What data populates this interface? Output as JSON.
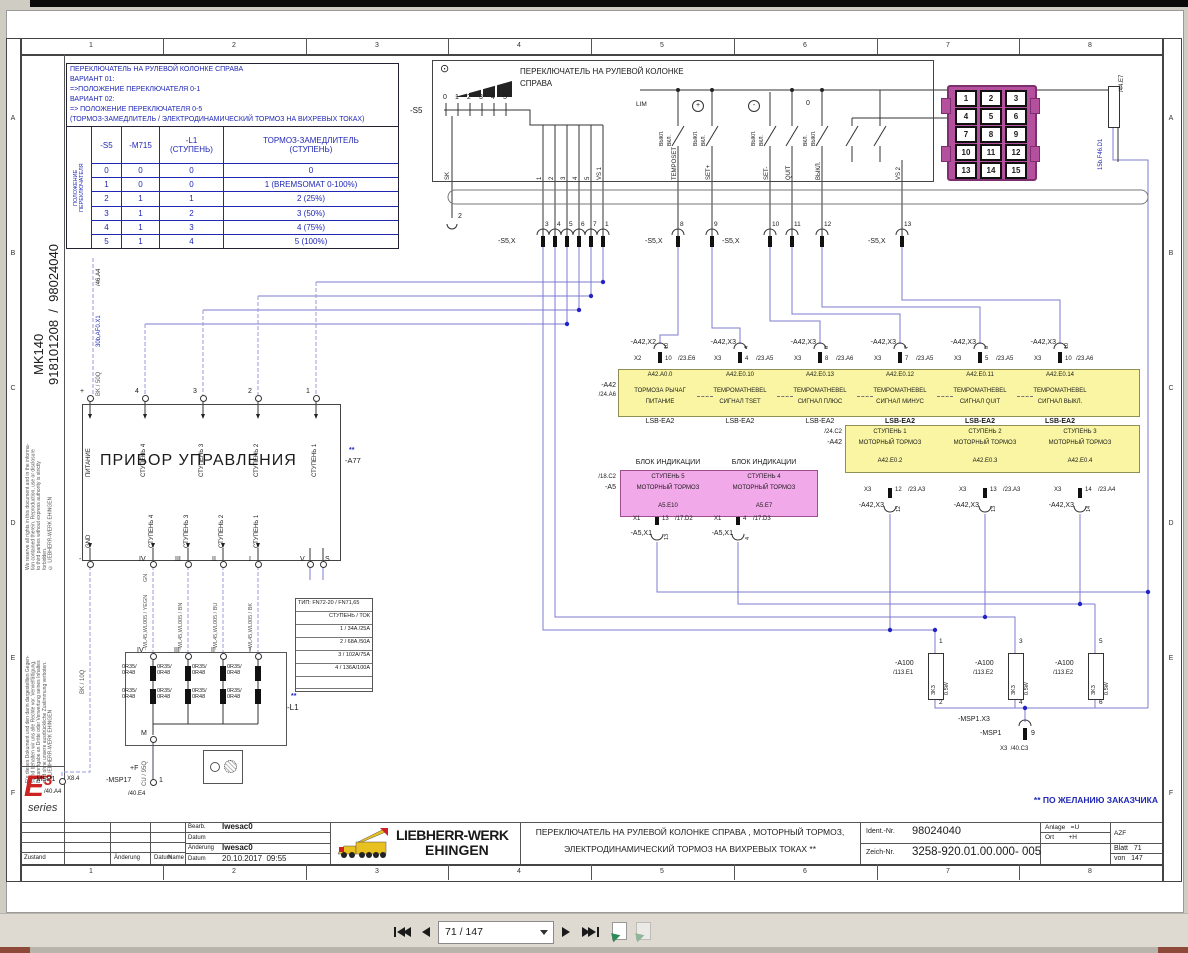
{
  "frame": {
    "cols": [
      "1",
      "2",
      "3",
      "4",
      "5",
      "6",
      "7",
      "8"
    ],
    "rows": [
      "A",
      "B",
      "C",
      "D",
      "E",
      "F"
    ]
  },
  "sidebar": {
    "copyright_en": "We reserve all rights in this document and in the informa-\ntion contained therein. Reproduction, use or disclosure\nto third parties without express authority is strictly\nforbidden.\n© LIEBHERR-WERK EHINGEN",
    "copyright_de": "Für dieses Dokument und den darin dargestellten Gegen-\nstand behalten wir uns alle Rechte vor. Vervielfältigung,\nBekanntgabe an Dritte oder Verwertung seines Inhaltes\nsind ohne unsere ausdrückliche Zustimmung verboten.\n© LIEBHERR-WERK EHINGEN",
    "model": "MK140",
    "doc_no": "918101208  /  98024040",
    "logo_e": "E",
    "logo_3": "3",
    "logo_series": "series"
  },
  "info_box": {
    "l1": "ПЕРЕКЛЮЧАТЕЛЬ НА РУЛЕВОЙ КОЛОНКЕ СПРАВА",
    "l2": "ВАРИАНТ 01:",
    "l3": "=>ПОЛОЖЕНИЕ ПЕРЕКЛЮЧАТЕЛЯ 0-1",
    "l4": "ВАРИАНТ 02:",
    "l5": "=> ПОЛОЖЕНИЕ ПЕРЕКЛЮЧАТЕЛЯ 0-5",
    "l6": "(ТОРМОЗ-ЗАМЕДЛИТЕЛЬ / ЭЛЕКТРОДИНАМИЧЕСКИЙ ТОРМОЗ НА ВИХРЕВЫХ ТОКАХ)"
  },
  "vt": {
    "side": "ПОЛОЖЕНИЕ\nПЕРЕКЛЮЧАТЕЛЯ",
    "h1": "-S5",
    "h2": "-M715",
    "h3": "-L1\n(СТУПЕНЬ)",
    "h4": "ТОРМОЗ-ЗАМЕДЛИТЕЛЬ\n(СТУПЕНЬ)",
    "rows": [
      [
        "0",
        "0",
        "0",
        "0"
      ],
      [
        "1",
        "0",
        "0",
        "1 (BREMSOMAT 0-100%)"
      ],
      [
        "2",
        "1",
        "1",
        "2 (25%)"
      ],
      [
        "3",
        "1",
        "2",
        "3 (50%)"
      ],
      [
        "4",
        "1",
        "3",
        "4 (75%)"
      ],
      [
        "5",
        "1",
        "4",
        "5 (100%)"
      ]
    ]
  },
  "sw": {
    "ref": "-S5",
    "title": "ПЕРЕКЛЮЧАТЕЛЬ НА РУЛЕВОЙ КОЛОНКЕ",
    "title2": "СПРАВА",
    "p0": "0",
    "p1": "1",
    "p2": "2",
    "p3": "3",
    "p4": "4",
    "p5": "5",
    "lim": "LIM",
    "plus": "+",
    "minus": "-",
    "zero": "0",
    "on": "ВКЛ.",
    "off": "ВЫКЛ.",
    "pin2": "2",
    "sk": "SK",
    "t1": "1",
    "t2": "2",
    "t3": "3",
    "t4": "4",
    "t5": "5",
    "vs1": "VS 1",
    "temposet": "TEMPOSET",
    "setp": "SET+",
    "setm": "SET-",
    "quit": "QUIT",
    "toff": "ВЫКЛ.",
    "vs2": "VS 2"
  },
  "s5x": {
    "label": "-S5,X",
    "p1": "3",
    "p2": "4",
    "p3": "5",
    "p4": "6",
    "p5": "7",
    "p6": "1",
    "p7": "8",
    "p8": "9",
    "p9": "10",
    "p10": "11",
    "p11": "12",
    "p12": "13"
  },
  "feeds": {
    "f1_ref": "/46.A4",
    "f1": "30b,AF0.X1",
    "f1_wire": "BK / 50Q",
    "gnd_wire": "BK / 10Q",
    "m_wire": "CU / 95Q",
    "gn": "GN",
    "fuse_ref": "/44.E7",
    "fuse": "15b.F46.D1"
  },
  "connector15": {
    "pins": [
      "1",
      "2",
      "3",
      "4",
      "5",
      "6",
      "7",
      "8",
      "9",
      "10",
      "11",
      "12",
      "13",
      "14",
      "15"
    ]
  },
  "a42": {
    "ref": "-A42",
    "xref": "/24.A6",
    "bus": "LSB-EA2",
    "channels": [
      {
        "conn": "-A42,X2",
        "plug": "X2",
        "pin": "10",
        "cref": "/23.E6",
        "addr": "A42.A0.0",
        "l1": "ТОРМОЗА РЫЧАГ",
        "l2": "ПИТАНИЕ"
      },
      {
        "conn": "-A42,X3",
        "plug": "X3",
        "pin": "4",
        "cref": "/23.A5",
        "addr": "A42.E0.10",
        "l1": "TEMPOMATHEBEL",
        "l2": "СИГНАЛ TSET"
      },
      {
        "conn": "-A42,X3",
        "plug": "X3",
        "pin": "8",
        "cref": "/23.A6",
        "addr": "A42.E0.13",
        "l1": "TEMPOMATHEBEL",
        "l2": "СИГНАЛ ПЛЮС"
      },
      {
        "conn": "-A42,X3",
        "plug": "X3",
        "pin": "7",
        "cref": "/23.A5",
        "addr": "A42.E0.12",
        "l1": "TEMPOMATHEBEL",
        "l2": "СИГНАЛ МИНУС"
      },
      {
        "conn": "-A42,X3",
        "plug": "X3",
        "pin": "5",
        "cref": "/23.A5",
        "addr": "A42.E0.11",
        "l1": "TEMPOMATHEBEL",
        "l2": "СИГНАЛ QUIT"
      },
      {
        "conn": "-A42,X3",
        "plug": "X3",
        "pin": "10",
        "cref": "/23.A6",
        "addr": "A42.E0.14",
        "l1": "TEMPOMATHEBEL",
        "l2": "СИГНАЛ ВЫКЛ."
      }
    ]
  },
  "a42m": {
    "ref": "-A42",
    "xref": "/24.C2",
    "channels": [
      {
        "l1": "СТУПЕНЬ 1",
        "l2": "МОТОРНЫЙ ТОРМОЗ",
        "addr": "A42.E0.2",
        "plug": "X3",
        "pin": "12",
        "cref": "/23.A3",
        "conn": "-A42,X3"
      },
      {
        "l1": "СТУПЕНЬ 2",
        "l2": "МОТОРНЫЙ ТОРМОЗ",
        "addr": "A42.E0.3",
        "plug": "X3",
        "pin": "13",
        "cref": "/23.A3",
        "conn": "-A42,X3"
      },
      {
        "l1": "СТУПЕНЬ 3",
        "l2": "МОТОРНЫЙ ТОРМОЗ",
        "addr": "A42.E0.4",
        "plug": "X3",
        "pin": "14",
        "cref": "/23.A4",
        "conn": "-A42,X3"
      }
    ]
  },
  "a5": {
    "ref": "-A5",
    "xref": "/18.C2",
    "header": "БЛОК ИНДИКАЦИИ",
    "channels": [
      {
        "l1": "СТУПЕНЬ 5",
        "l2": "МОТОРНЫЙ ТОРМОЗ",
        "addr": "A5.E10",
        "plug": "X1",
        "pin": "13",
        "cref": "/17.D2",
        "conn": "-A5,X1"
      },
      {
        "l1": "СТУПЕНЬ 4",
        "l2": "МОТОРНЫЙ ТОРМОЗ",
        "addr": "A5.E7",
        "plug": "X1",
        "pin": "4",
        "cref": "/17.D3",
        "conn": "-A5,X1"
      }
    ]
  },
  "a77": {
    "title": "ПРИБОР УПРАВЛЕНИЯ",
    "ref": "-A77",
    "stars": "**",
    "top": [
      {
        "n": "+",
        "l": "ПИТАНИЕ"
      },
      {
        "n": "4",
        "l": "СТУПЕНЬ 4"
      },
      {
        "n": "3",
        "l": "СТУПЕНЬ 3"
      },
      {
        "n": "2",
        "l": "СТУПЕНЬ 2"
      },
      {
        "n": "1",
        "l": "СТУПЕНЬ 1"
      }
    ],
    "bottom": [
      {
        "n": "-",
        "l": "GND"
      },
      {
        "n": "IV",
        "l": "СТУПЕНЬ 4"
      },
      {
        "n": "III",
        "l": "СТУПЕНЬ 3"
      },
      {
        "n": "II",
        "l": "СТУПЕНЬ 2"
      },
      {
        "n": "I",
        "l": "СТУПЕНЬ 1"
      },
      {
        "n": "V",
        "l": ""
      },
      {
        "n": "S",
        "l": ""
      }
    ]
  },
  "l1b": {
    "ref": "-L1",
    "stars": "**",
    "m": "M",
    "t1": "IV",
    "t2": "III",
    "t3": "II",
    "t4": "I",
    "r": "0R35/\n0R48",
    "w1": "-WL45,WL005 / YEGN",
    "w2": "-WL45,WL005 / BN",
    "w3": "-WL45,WL005 / BU",
    "w4": "-WL45,WL005 / BK"
  },
  "ttable": {
    "r1": "ТИП: FN72-20 / FN71,65",
    "r2": "СТУПЕНЬ / ТОК",
    "r3": "1 / 34A /25A",
    "r4": "2 / 68A /50A",
    "r5": "3 / 102A/75A",
    "r6": "4 / 136A/100A"
  },
  "a100": {
    "units": [
      {
        "ref": "-A100",
        "xref": "/113.E1",
        "pt": "1",
        "pb": "2",
        "val": "3K3",
        "pw": "0.5W"
      },
      {
        "ref": "-A100",
        "xref": "/113.E2",
        "pt": "3",
        "pb": "4",
        "val": "3K3",
        "pw": "0.5W"
      },
      {
        "ref": "-A100",
        "xref": "/113.E2",
        "pt": "5",
        "pb": "6",
        "val": "3K3",
        "pw": "0.5W"
      }
    ],
    "conn": "-MSP1.X3",
    "dev": "-MSP1",
    "pin": "9",
    "cref": "X3  /40.C3"
  },
  "msp": {
    "a": "-MSP1",
    "ap": "X8.4",
    "ar": "/40.A4",
    "plusf": "+F",
    "b": "-MSP17",
    "bp": "1",
    "br": "/40.E4"
  },
  "note": "** ПО ЖЕЛАНИЮ ЗАКАЗЧИКА",
  "tb": {
    "zustand": "Zustand",
    "aenderung": "Änderung",
    "datum": "Datum",
    "name": "Name",
    "bearb": "Bearb.",
    "datum2": "Datum",
    "aend2": "Änderung",
    "datum3": "Datum",
    "v_bearb": "lwesac0",
    "v_aend": "lwesac0",
    "v_datum": "20.10.2017  09:55",
    "company1": "LIEBHERR-WERK",
    "company2": "EHINGEN",
    "title1": "ПЕРЕКЛЮЧАТЕЛЬ НА РУЛЕВОЙ КОЛОНКЕ СПРАВА , МОТОРНЫЙ ТОРМОЗ,",
    "title2": "ЭЛЕКТРОДИНАМИЧЕСКИЙ ТОРМОЗ НА ВИХРЕВЫХ ТОКАХ **",
    "ident_l": "Ident.-Nr.",
    "ident": "98024040",
    "zeich_l": "Zeich-Nr.",
    "zeich": "3258-920.01.00.000- 005",
    "anlage": "Anlage   =U",
    "ort": "Ort        +H",
    "azf": "AZF",
    "blatt": "Blatt   71",
    "von": "von   147"
  },
  "toolbar": {
    "page": "71 / 147"
  }
}
